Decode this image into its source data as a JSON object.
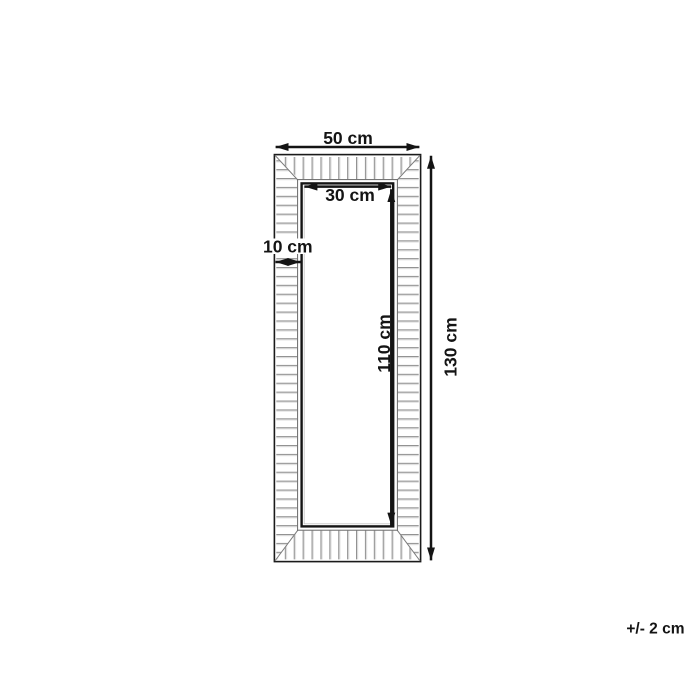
{
  "diagram": {
    "type": "product-dimension-diagram",
    "subject": "rectangular mirror frame, front view",
    "dimensions": [
      {
        "id": "outer-width",
        "label": "50 cm",
        "value": 50,
        "unit": "cm",
        "orientation": "horizontal"
      },
      {
        "id": "inner-width",
        "label": "30 cm",
        "value": 30,
        "unit": "cm",
        "orientation": "horizontal"
      },
      {
        "id": "frame-depth",
        "label": "10 cm",
        "value": 10,
        "unit": "cm",
        "orientation": "horizontal"
      },
      {
        "id": "inner-height",
        "label": "110 cm",
        "value": 110,
        "unit": "cm",
        "orientation": "vertical"
      },
      {
        "id": "outer-height",
        "label": "130 cm",
        "value": 130,
        "unit": "cm",
        "orientation": "vertical"
      }
    ],
    "tolerance": {
      "label": "+/- 2 cm",
      "value": 2,
      "unit": "cm"
    },
    "colors": {
      "line": "#141414",
      "hatch": "#8c8c8c",
      "hatch_highlight": "#dcdcdc",
      "miter": "#7a7a7a",
      "lip": "#686868",
      "background": "#ffffff"
    }
  }
}
